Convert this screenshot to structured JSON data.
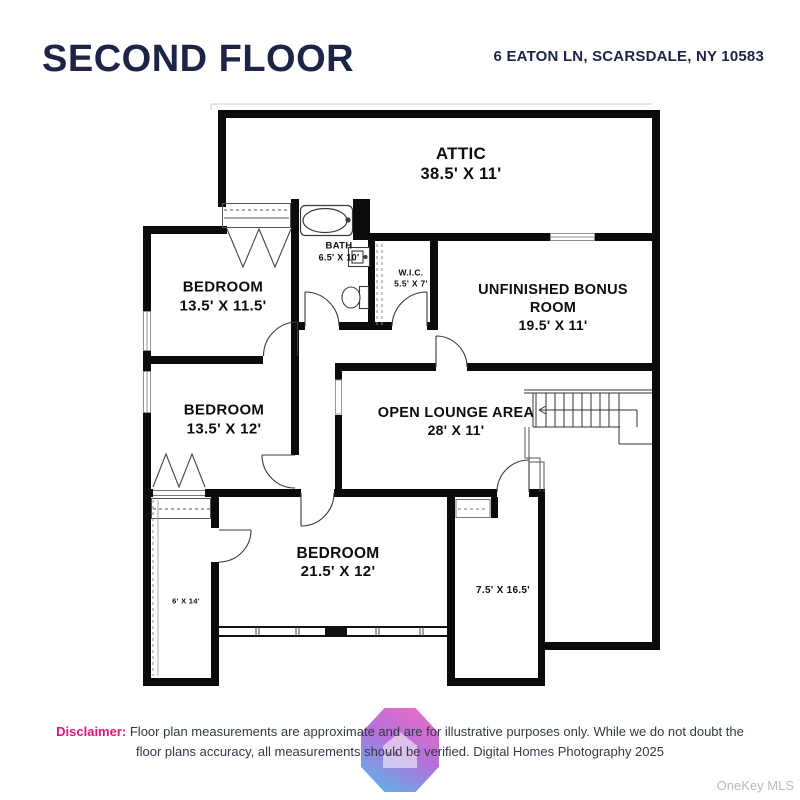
{
  "header": {
    "title": "SECOND FLOOR",
    "address": "6 EATON LN, SCARSDALE, NY 10583"
  },
  "plan": {
    "rooms": [
      {
        "id": "attic",
        "name": "ATTIC",
        "dims": "38.5' X 11'"
      },
      {
        "id": "bedroom-1",
        "name": "BEDROOM",
        "dims": "13.5' X 11.5'"
      },
      {
        "id": "bath",
        "name": "BATH",
        "dims": "6.5' X 10'"
      },
      {
        "id": "wic",
        "name": "W.I.C.",
        "dims": "5.5' X 7'"
      },
      {
        "id": "bonus-room",
        "name": "UNFINISHED BONUS ROOM",
        "dims": "19.5' X 11'"
      },
      {
        "id": "bedroom-2",
        "name": "BEDROOM",
        "dims": "13.5' X 12'"
      },
      {
        "id": "open-lounge",
        "name": "OPEN LOUNGE AREA",
        "dims": "28' X 11'"
      },
      {
        "id": "bedroom-3",
        "name": "BEDROOM",
        "dims": "21.5' X 12'"
      },
      {
        "id": "closet-6x14",
        "name": "",
        "dims": "6' X 14'"
      },
      {
        "id": "room-7x16",
        "name": "",
        "dims": "7.5' X 16.5'"
      }
    ]
  },
  "footer": {
    "disclaimer_label": "Disclaimer:",
    "disclaimer_text": "Floor plan measurements are approximate and are for illustrative purposes only. While we do not doubt the floor plans accuracy, all measurements should be verified. Digital Homes Photography 2025",
    "watermark": "OneKey MLS"
  },
  "colors": {
    "title_navy": "#1d2445",
    "wall_black": "#0b0b0b",
    "disclaimer_pink": "#e8127c",
    "watermark_gray": "#b8babc",
    "logo_gradient_top": "#f065c2",
    "logo_gradient_bottom": "#47b9e9"
  }
}
